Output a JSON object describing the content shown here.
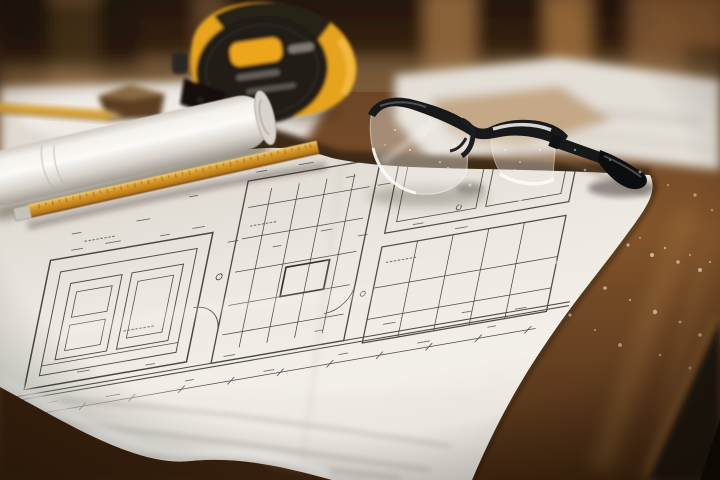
{
  "scene": {
    "type": "photograph",
    "title": "Construction blueprints on a wooden table",
    "description": "Close-up photo of hand-drawn architectural blueprints spread on a dark wooden dining table with a yellow-and-black tape measure, clear safety glasses, a rolled plan sheet, an amber wooden rule with a metal tip, a blurred pencil and wood block, out-of-focus wooden chairs in the background, and sawdust scattered on the table.",
    "lighting": "warm indoor light, shallow depth of field, blurred background and foreground",
    "palette": {
      "room_dark": "#241607",
      "chair_wood": "#8a6238",
      "table_wood": "#7d512a",
      "table_shadow": "#1d1208",
      "paper_white": "#efece5",
      "paper_shaded": "#a9a49c",
      "blueprint_ink": "#4b4842",
      "tape_measure_yellow": "#e6a31e",
      "tape_measure_black": "#1d1a15",
      "ruler_amber": "#d2912c",
      "glasses_frame": "#17181a",
      "sawdust": "#f5ead8",
      "beige_paper": "#c4a887"
    }
  },
  "objects": [
    {
      "name": "blueprint-sheet",
      "label": "Large hand-drawn architectural blueprint sheet with dense pencil linework, creases and folded bottom edge"
    },
    {
      "name": "rolled-plan",
      "label": "Rolled-up white plan sheet lying diagonally at the left"
    },
    {
      "name": "tape-measure",
      "label": "Round yellow and black tape measure, slightly out of focus"
    },
    {
      "name": "safety-glasses",
      "label": "Clear safety glasses with black frame resting on the blueprint"
    },
    {
      "name": "wooden-ruler",
      "label": "Amber wooden rule with tick marks and a silver metal tip"
    },
    {
      "name": "pencil",
      "label": "Blurred carpenter pencil at top left"
    },
    {
      "name": "wood-block",
      "label": "Small blurred wood block on papers at top left"
    },
    {
      "name": "background-chairs",
      "label": "Out-of-focus wooden chair backs and spindles"
    },
    {
      "name": "scattered-papers",
      "label": "Blurred white and beige papers scattered on the table"
    },
    {
      "name": "sawdust",
      "label": "White sawdust specks scattered across the table and lenses"
    },
    {
      "name": "table",
      "label": "Dark brown wooden table with edge falling into shadow at bottom right"
    }
  ]
}
